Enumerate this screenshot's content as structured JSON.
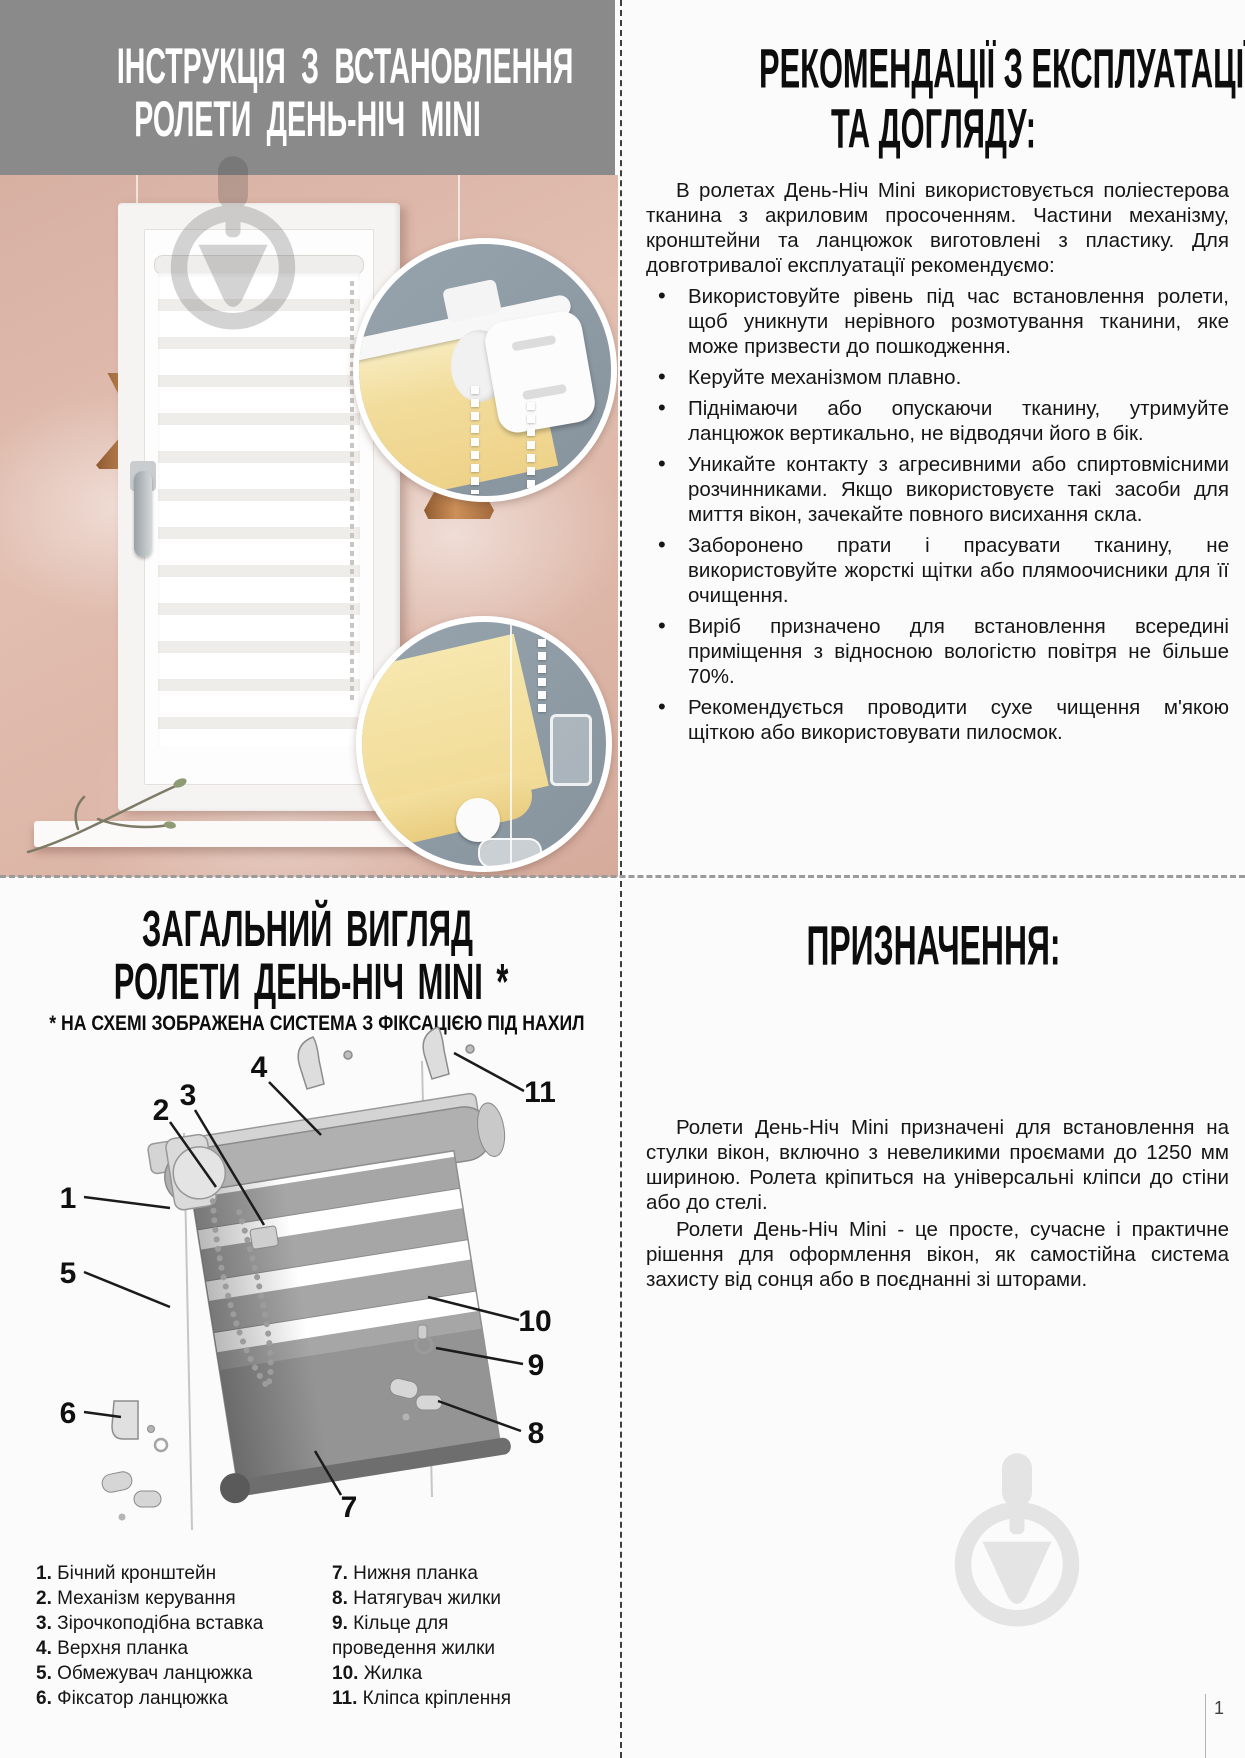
{
  "install_section": {
    "title_line1": "ІНСТРУКЦІЯ З ВСТАНОВЛЕННЯ",
    "title_line2": "РОЛЕТИ ДЕНЬ-НІЧ MINI"
  },
  "recommendations": {
    "title_line1": "РЕКОМЕНДАЦІЇ З ЕКСПЛУАТАЦІЇ",
    "title_line2": "ТА ДОГЛЯДУ:",
    "intro": "В ролетах День-Ніч Mini використовується поліестерова тканина з акриловим просоченням. Частини механізму, кронштейни та ланцюжок виготовлені з пластику. Для довготривалої експлуатації рекомендуємо:",
    "bullet_marker": "•",
    "bullets": [
      "Використовуйте рівень під час встановлення ролети, щоб уникнути нерівного розмотування тканини, яке може призвести до пошкодження.",
      "Керуйте механізмом плавно.",
      "Піднімаючи або опускаючи тканину, утримуйте ланцюжок вертикально, не відводячи його в бік.",
      "Уникайте контакту з агресивними або спиртовмісними розчинниками. Якщо використовуєте такі засоби для миття вікон, зачекайте повного висихання скла.",
      "Заборонено прати і прасувати тканину, не використовуйте жорсткі щітки або плямоочисники для її очищення.",
      "Виріб призначено для встановлення всередині приміщення з відносною вологістю повітря не більше 70%.",
      "Рекомендується проводити сухе чищення м'якою щіткою або використовувати пилосмок."
    ]
  },
  "overview": {
    "title_line1": "ЗАГАЛЬНИЙ ВИГЛЯД",
    "title_line2": "РОЛЕТИ ДЕНЬ-НІЧ MINI *",
    "subtitle": "* НА СХЕМІ ЗОБРАЖЕНА СИСТЕМА З ФІКСАЦІЄЮ ПІД НАХИЛ",
    "diagram_labels": [
      "1",
      "2",
      "3",
      "4",
      "5",
      "6",
      "7",
      "8",
      "9",
      "10",
      "11"
    ],
    "legend_left": [
      {
        "num": "1.",
        "label": "Бічний кронштейн"
      },
      {
        "num": "2.",
        "label": "Механізм керування"
      },
      {
        "num": "3.",
        "label": "Зірочкоподібна вставка"
      },
      {
        "num": "4.",
        "label": "Верхня планка"
      },
      {
        "num": "5.",
        "label": "Обмежувач ланцюжка"
      },
      {
        "num": "6.",
        "label": "Фіксатор ланцюжка"
      }
    ],
    "legend_right": [
      {
        "num": "7.",
        "label": "Нижня планка"
      },
      {
        "num": "8.",
        "label": "Натягувач жилки"
      },
      {
        "num": "9.",
        "label": "Кільце для проведення жилки"
      },
      {
        "num": "10.",
        "label": "Жилка"
      },
      {
        "num": "11.",
        "label": "Кліпса кріплення"
      }
    ]
  },
  "purpose": {
    "title": "ПРИЗНАЧЕННЯ:",
    "paragraph1": "Ролети День-Ніч Mini призначені для встановлення на стулки вікон, включно з невеликими проємами до 1250 мм шириною. Ролета кріпиться на універсальні кліпси до стіни або до стелі.",
    "paragraph2": "Ролети День-Ніч Mini - це просте, сучасне і практичне рішення для оформлення вікон, як самостійна система захисту від сонця або в поєднанні зі шторами."
  },
  "page": {
    "number": "1"
  },
  "colors": {
    "header_bg": "#8a8a8a",
    "wall_pink": "#dcb5a7",
    "inset_bg": "#8e9ba5",
    "blind_yellow": "#f2dd9d",
    "copper": "#b97c4e",
    "watermark_light": "#e4e4e4"
  }
}
